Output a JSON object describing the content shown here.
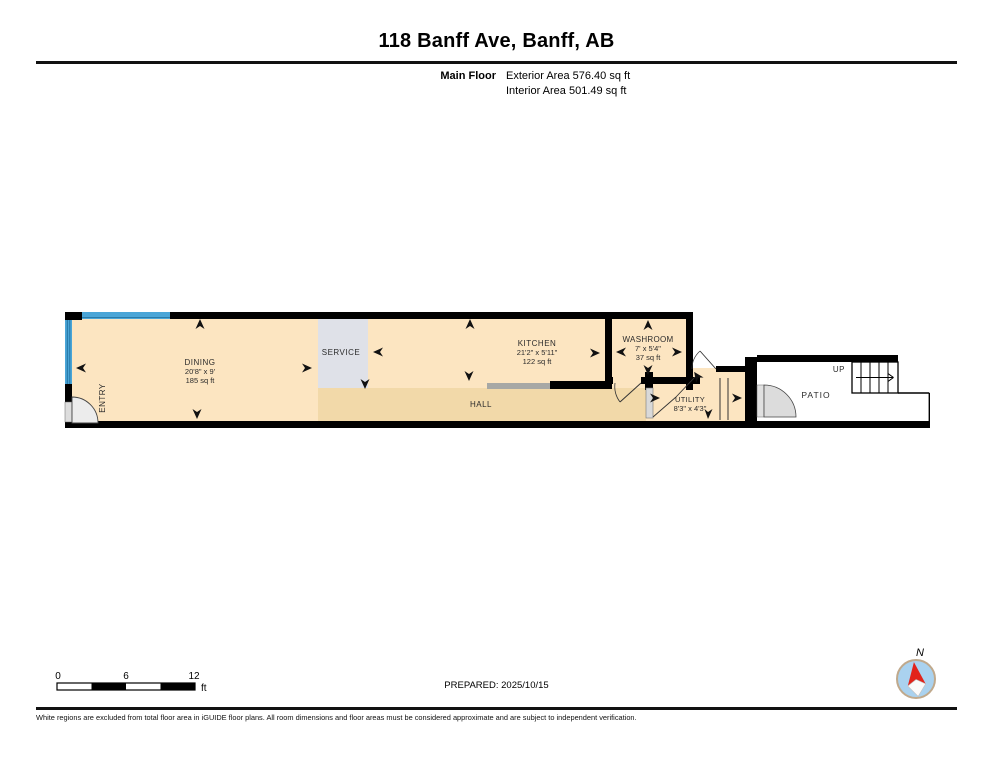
{
  "header": {
    "title": "118 Banff Ave, Banff, AB",
    "floor_label": "Main Floor",
    "exterior_area": "Exterior Area 576.40 sq ft",
    "interior_area": "Interior Area 501.49 sq ft"
  },
  "rooms": {
    "entry": {
      "name": "ENTRY"
    },
    "dining": {
      "name": "DINING",
      "dims": "20'8\" x 9'",
      "area": "185 sq ft"
    },
    "service": {
      "name": "SERVICE"
    },
    "kitchen": {
      "name": "KITCHEN",
      "dims": "21'2\" x 5'11\"",
      "area": "122 sq ft"
    },
    "washroom": {
      "name": "WASHROOM",
      "dims": "7' x 5'4\"",
      "area": "37 sq ft"
    },
    "hall": {
      "name": "HALL"
    },
    "utility": {
      "name": "UTILITY",
      "dims": "8'3\" x 4'3\""
    },
    "patio": {
      "name": "PATIO"
    },
    "stairs": {
      "label": "UP"
    }
  },
  "scale_bar": {
    "start": "0",
    "mid": "6",
    "end": "12",
    "unit": "ft"
  },
  "compass": {
    "label": "N"
  },
  "footer": {
    "prepared": "PREPARED: 2025/10/15",
    "disclaimer": "White regions are excluded from total floor area in iGUIDE floor plans. All room dimensions and floor areas must be considered approximate and are subject to independent verification."
  },
  "colors": {
    "room_fill": "#fce5c1",
    "hall_fill": "#f2d9a9",
    "service_fill": "#dfe1e8",
    "wall": "#000000",
    "window_blue": "#4aa5d7",
    "compass_red": "#e2231a",
    "compass_blue": "#aad2ef"
  }
}
